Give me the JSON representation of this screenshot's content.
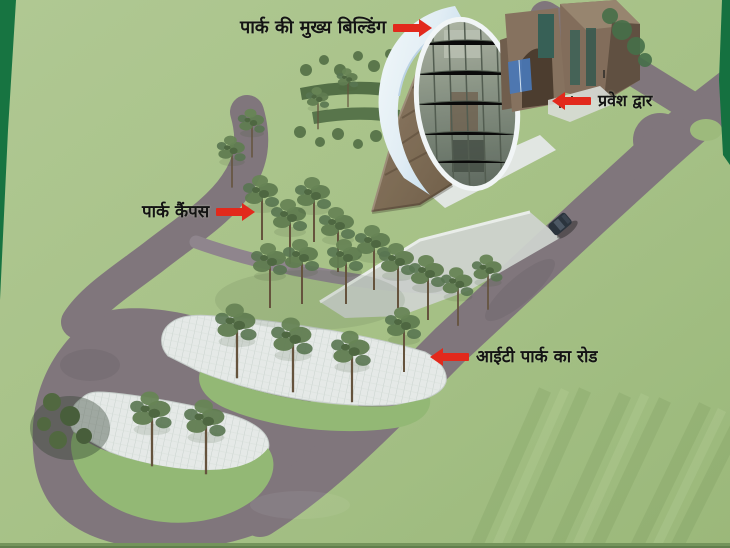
{
  "annotations": {
    "main_building": {
      "text": "पार्क की मुख्य बिल्डिंग",
      "arrow": "right"
    },
    "entrance_gate": {
      "text": "प्रवेश द्वार",
      "arrow": "left"
    },
    "park_campus": {
      "text": "पार्क कैंपस",
      "arrow": "right"
    },
    "it_park_road": {
      "text": "आईटी पार्क का रोड",
      "arrow": "left"
    }
  },
  "colors": {
    "arrow_red": "#e2291c",
    "grass_green": "#a3bf82",
    "road_gray": "#7b7177",
    "parking_white": "#e4e9e7",
    "border_green": "#0e6f3a"
  }
}
